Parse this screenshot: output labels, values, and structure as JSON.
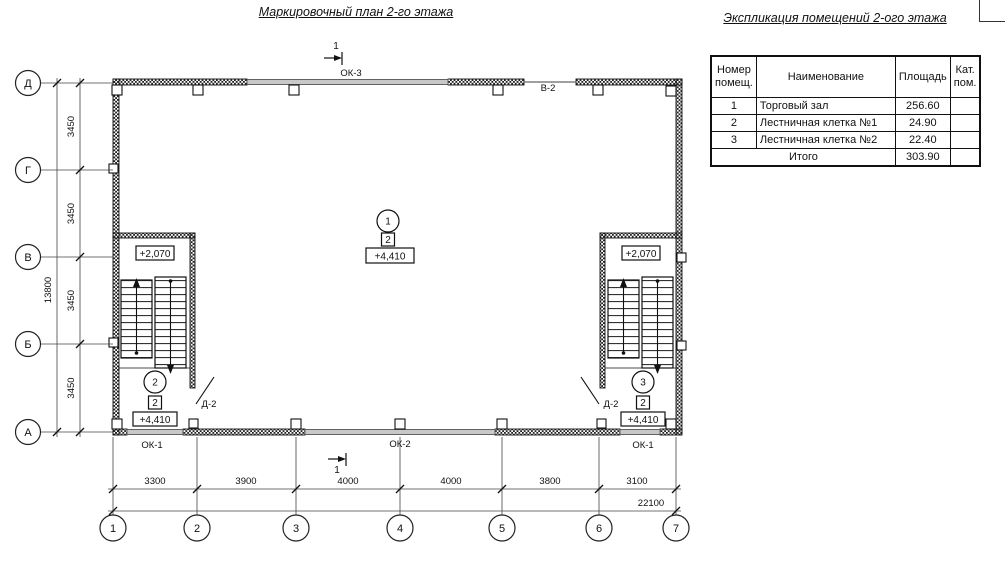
{
  "plan": {
    "title": "Маркировочный план 2-го этажа",
    "section_mark": "1",
    "labels": {
      "ok3": "ОК-3",
      "v2": "В-2",
      "ok1_left": "ОК-1",
      "ok2": "ОК-2",
      "ok1_right": "ОК-1",
      "d2_left": "Д-2",
      "d2_right": "Д-2"
    },
    "rooms": {
      "hall": {
        "number": "1",
        "category": "2",
        "level": "+4,410"
      },
      "stair_left": {
        "number": "2",
        "category": "2",
        "level": "+4,410",
        "upper_level": "+2,070"
      },
      "stair_right": {
        "number": "3",
        "category": "2",
        "level": "+4,410",
        "upper_level": "+2,070"
      }
    },
    "axes": {
      "rows": [
        "Д",
        "Г",
        "В",
        "Б",
        "А"
      ],
      "cols": [
        "1",
        "2",
        "3",
        "4",
        "5",
        "6",
        "7"
      ]
    },
    "dimensions": {
      "row_segments": [
        "3450",
        "3450",
        "3450",
        "3450"
      ],
      "row_total": "13800",
      "col_segments": [
        "3300",
        "3900",
        "4000",
        "4000",
        "3800",
        "3100"
      ],
      "col_total": "22100"
    }
  },
  "table": {
    "title": "Экспликация помещений 2-ого этажа",
    "headers": {
      "number": "Номер\nпомещ.",
      "name": "Наименование",
      "area": "Площадь",
      "category": "Кат.\nпом."
    },
    "rows": [
      {
        "num": "1",
        "name": "Торговый зал",
        "area": "256.60",
        "cat": ""
      },
      {
        "num": "2",
        "name": "Лестничная клетка №1",
        "area": "24.90",
        "cat": ""
      },
      {
        "num": "3",
        "name": "Лестничная клетка №2",
        "area": "22.40",
        "cat": ""
      }
    ],
    "total": {
      "label": "Итого",
      "value": "303.90"
    }
  }
}
